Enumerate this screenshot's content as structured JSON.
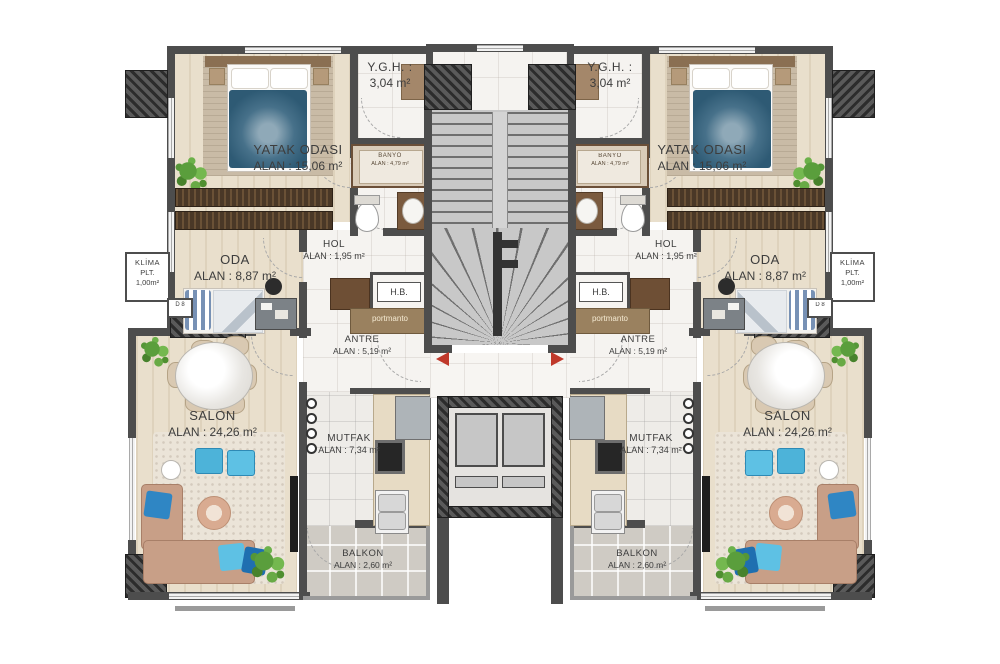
{
  "plan_title": "apartment-floor-plan",
  "colors": {
    "wall": "#4d4d4d",
    "column_hatch": "#2c2c2c",
    "wood_floor": "#e9dfcc",
    "marble_floor": "#f5f3f0",
    "balcony_tile": "#cfcbc4",
    "stair_gray": "#c8c8c8",
    "accent_red": "#c0392b",
    "bed_duvet_blue": "#2e5a74",
    "sofa_tan": "#c89f87",
    "cushion_blue": "#4db3d9",
    "plant_green": "#5a9e3c",
    "portmanto_bar": "#9a815f"
  },
  "rooms": {
    "ygh": {
      "name": "Y.G.H. :",
      "area": "3,04 m²"
    },
    "yatak_odasi": {
      "name": "YATAK ODASI",
      "area": "ALAN : 15,06 m²"
    },
    "banyo": {
      "name": "BANYO",
      "area": "ALAN : 4,79 m²"
    },
    "oda": {
      "name": "ODA",
      "area": "ALAN : 8,87 m²"
    },
    "hol": {
      "name": "HOL",
      "area": "ALAN : 1,95 m²"
    },
    "hb": {
      "name": "H.B."
    },
    "portmanto": {
      "name": "portmanto"
    },
    "antre": {
      "name": "ANTRE",
      "area": "ALAN : 5,19 m²"
    },
    "klima": {
      "line1": "KLİMA",
      "line2": "PLT.",
      "line3": "1,00m²"
    },
    "door_tag": {
      "name": "D 8"
    },
    "salon": {
      "name": "SALON",
      "area": "ALAN : 24,26 m²"
    },
    "mutfak": {
      "name": "MUTFAK",
      "area": "ALAN : 7,34 m²"
    },
    "balkon": {
      "name": "BALKON",
      "area": "ALAN : 2,60 m²"
    }
  }
}
